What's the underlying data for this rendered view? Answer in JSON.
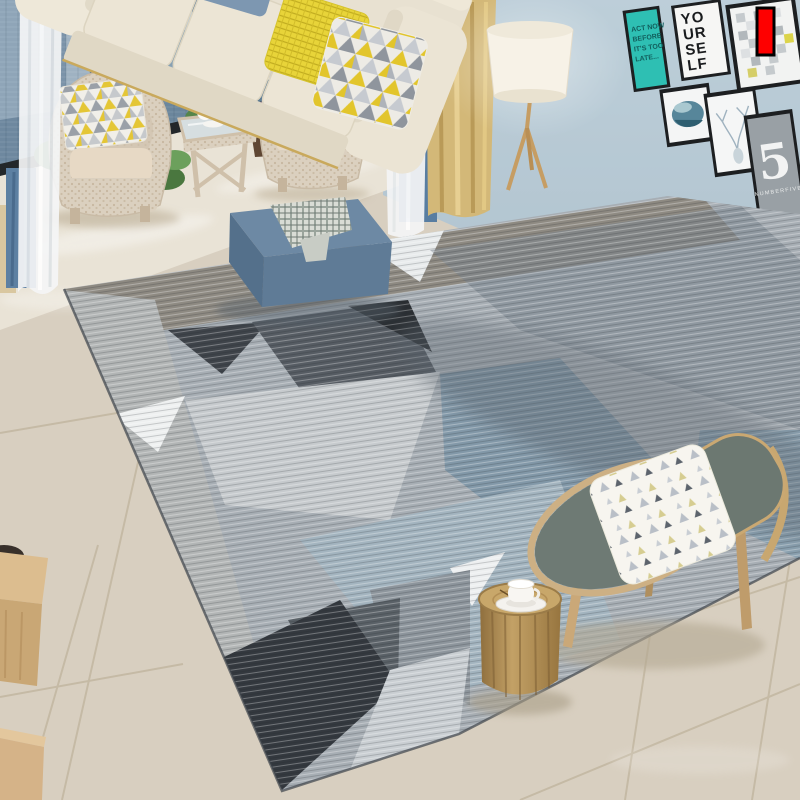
{
  "image_type": "living-room rug product photograph",
  "annotation": {
    "marker_color": "#fe0000",
    "marker_border": "#000000"
  },
  "wall_gallery": {
    "frame_color": "#1d1f21",
    "act_now_poster": {
      "bg_color": "#2ebfb3",
      "lines": [
        "ACT NOW",
        "BEFORE",
        "IT'S TOO",
        "LATE..."
      ]
    },
    "yourself_poster": {
      "lines": [
        "YO",
        "UR",
        "SE",
        "LF"
      ]
    },
    "five_poster": {
      "bg_color": "#99a0a5",
      "numeral": "5",
      "caption": "NUMBERFIVE"
    }
  },
  "palette": {
    "wall_blue": "#b6c9d4",
    "curtain_yellow": "#d3b878",
    "curtain_blue": "#5d80a2",
    "sofa_cream": "#e8e1d1",
    "pillow_yellow": "#f1cd17",
    "pillow_blue": "#7d97b1",
    "ottoman_blue": "#5f7b96",
    "rug_base_gray": "#a7aeb4",
    "rug_charcoal": "#3f444a",
    "rug_slate_blue": "#8aa0af",
    "floor_beige": "#d8cfc0"
  }
}
